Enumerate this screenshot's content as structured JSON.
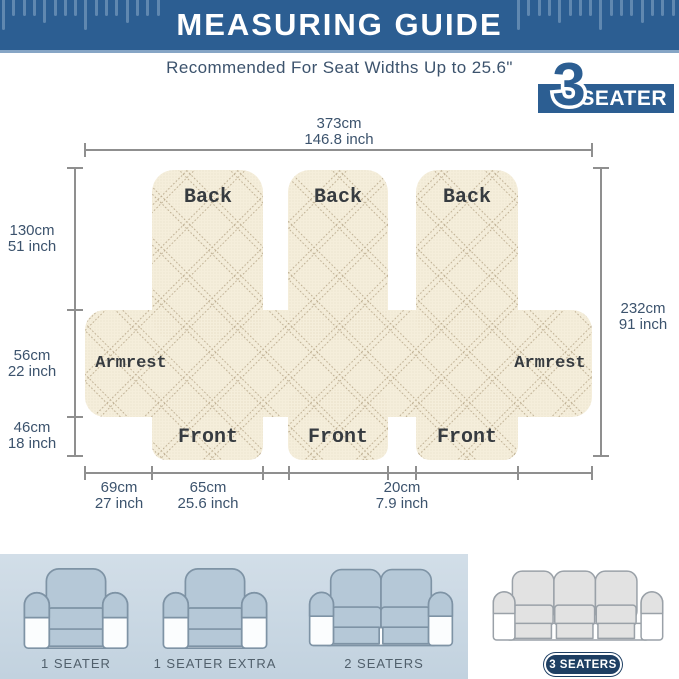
{
  "header": {
    "title": "MEASURING GUIDE"
  },
  "subtitle": "Recommended For Seat Widths Up to 25.6\"",
  "badge": {
    "number": "3",
    "label": "SEATER"
  },
  "diagram": {
    "width_top": {
      "cm": "373cm",
      "inch": "146.8 inch"
    },
    "height_right": {
      "cm": "232cm",
      "inch": "91 inch"
    },
    "left_segments": [
      {
        "cm": "130cm",
        "inch": "51 inch"
      },
      {
        "cm": "56cm",
        "inch": "22 inch"
      },
      {
        "cm": "46cm",
        "inch": "18 inch"
      }
    ],
    "bottom_segments": [
      {
        "cm": "69cm",
        "inch": "27 inch"
      },
      {
        "cm": "65cm",
        "inch": "25.6 inch"
      },
      {
        "cm": "20cm",
        "inch": "7.9 inch"
      }
    ],
    "back_labels": [
      "Back",
      "Back",
      "Back"
    ],
    "armrest_labels": [
      "Armrest",
      "Armrest"
    ],
    "front_labels": [
      "Front",
      "Front",
      "Front"
    ]
  },
  "footer": {
    "options": [
      {
        "label": "1 SEATER"
      },
      {
        "label": "1 SEATER EXTRA"
      },
      {
        "label": "2 SEATERS"
      },
      {
        "label": "3 SEATERS",
        "highlighted": true
      }
    ]
  },
  "colors": {
    "accent": "#2c5e92",
    "text_blue": "#3c536d",
    "fabric": "#f5eedb",
    "fabric_line": "#ab9878",
    "dim": "#8f8f8f",
    "panel": "#c9d7e3",
    "cover": "#b5c8d7",
    "navy": "#1e3f63"
  }
}
